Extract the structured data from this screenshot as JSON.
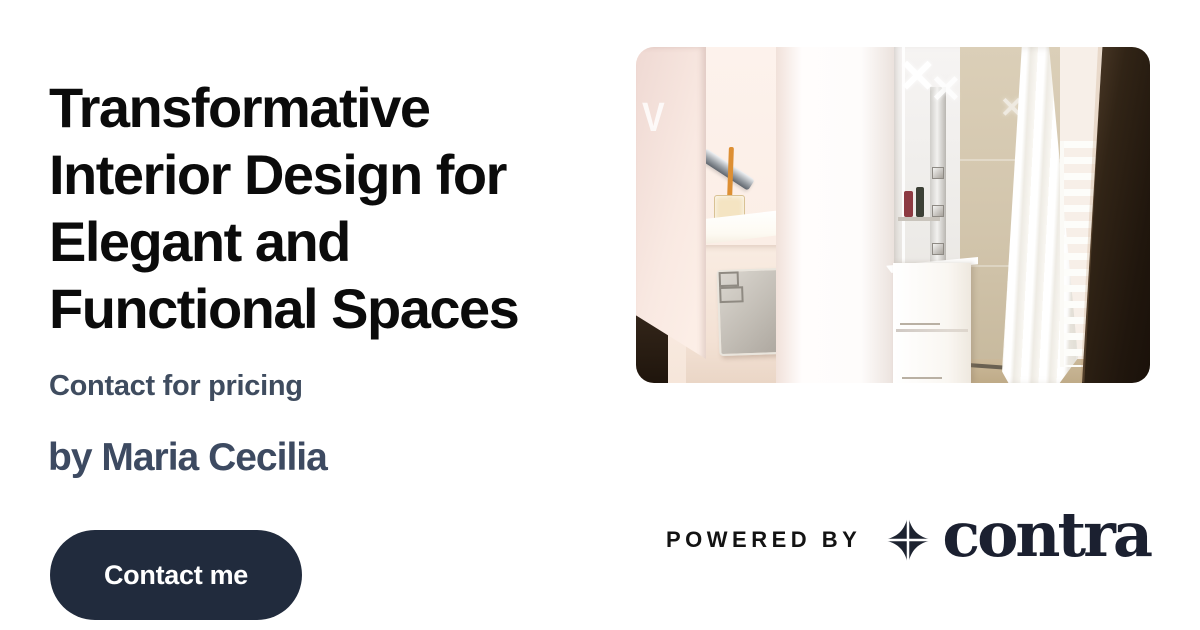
{
  "card": {
    "background": "#ffffff"
  },
  "title": {
    "full": "Transformative Interior Design for Elegant and Functional Spaces",
    "lines": [
      "Transformative",
      "Interior Design for",
      "Elegant and",
      "Functional Spaces"
    ],
    "color": "#0b0b0b"
  },
  "pricing": {
    "label": "Contact for pricing",
    "color": "#3f4c5f"
  },
  "byline": {
    "label": "by Maria Cecilia",
    "color": "#3d4a61"
  },
  "cta": {
    "label": "Contact me",
    "background": "#212b3d",
    "text_color": "#ffffff"
  },
  "photo": {
    "name": "bathroom-photo",
    "glint_marks": [
      "✕",
      "✕",
      "✕",
      "V"
    ]
  },
  "footer": {
    "powered_by": "POWERED BY",
    "brand": "contra",
    "brand_color": "#1b2030",
    "icon": "contra-star-icon"
  }
}
